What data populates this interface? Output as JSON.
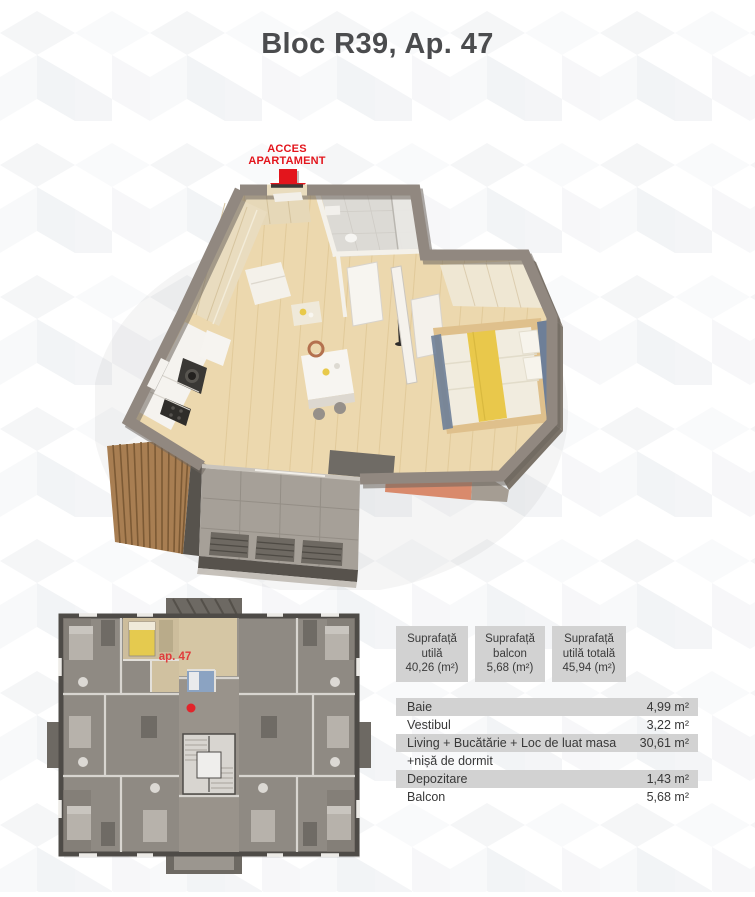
{
  "page": {
    "title": "Bloc R39, Ap. 47"
  },
  "access": {
    "line1": "ACCES",
    "line2": "APARTAMENT"
  },
  "mini_plan": {
    "unit_label": "ap. 47"
  },
  "summary": {
    "boxes": [
      {
        "label": "Suprafață utilă",
        "value": "40,26 (m²)"
      },
      {
        "label": "Suprafață balcon",
        "value": "5,68 (m²)"
      },
      {
        "label": "Suprafață utilă totală",
        "value": "45,94 (m²)"
      }
    ]
  },
  "areas": {
    "rows": [
      {
        "label": "Baie",
        "value": "4,99 m²"
      },
      {
        "label": "Vestibul",
        "value": "3,22 m²"
      },
      {
        "label": "Living + Bucătărie + Loc de luat masa",
        "value": "30,61 m²"
      },
      {
        "label": "+nișă de dormit",
        "value": ""
      },
      {
        "label": "Depozitare",
        "value": "1,43 m²"
      },
      {
        "label": "Balcon",
        "value": "5,68 m²"
      }
    ]
  },
  "colors": {
    "accent_red": "#e3151c",
    "panel_gray": "#d2d2d2",
    "title_gray": "#4b4c4e"
  }
}
